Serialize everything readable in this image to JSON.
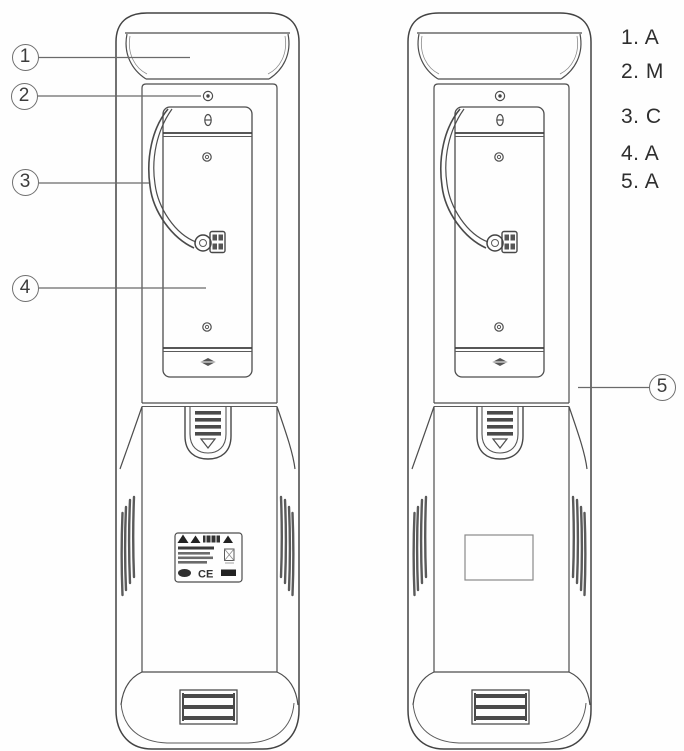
{
  "diagram": {
    "kind": "product-parts-diagram",
    "views": [
      "rear view with wired terminal",
      "rear view with blank label"
    ]
  },
  "callouts": [
    {
      "number": "1"
    },
    {
      "number": "2"
    },
    {
      "number": "3"
    },
    {
      "number": "4"
    },
    {
      "number": "5"
    }
  ],
  "legend": {
    "items": [
      "1. A",
      "2. M",
      "3. C",
      "4. A",
      "5. A"
    ]
  },
  "sticker": {
    "ce_mark": "CE"
  },
  "colors": {
    "line": "#4d4d4d",
    "dark_fill": "#4a4a4a",
    "callout": "#6a6a6a",
    "text": "#2e2e2e",
    "background": "#fefefe"
  }
}
